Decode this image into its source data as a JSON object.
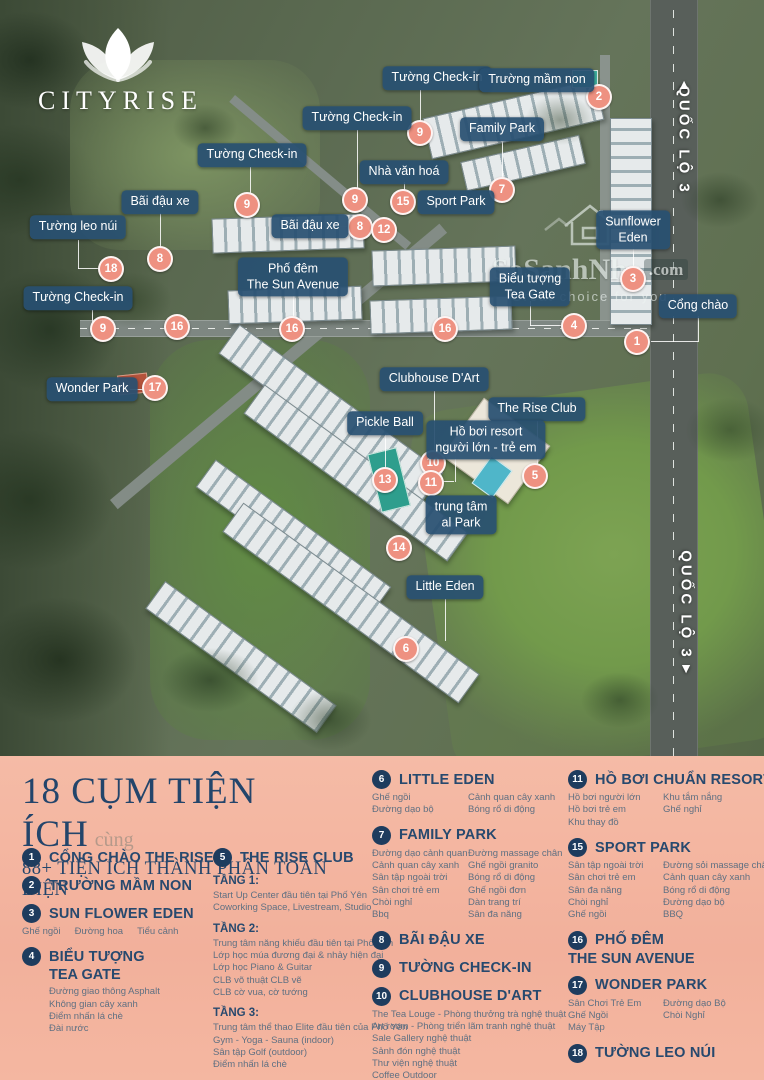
{
  "logo": {
    "brand": "CITYRISE"
  },
  "watermark": {
    "main": "SoSanhNha",
    "suffix": ".com",
    "tagline": "Great choice for you"
  },
  "map": {
    "callouts": [
      {
        "lines": [
          "Tường Check-in"
        ],
        "x": 437,
        "y": 78
      },
      {
        "lines": [
          "Trường mầm non"
        ],
        "x": 537,
        "y": 80
      },
      {
        "lines": [
          "Tường Check-in"
        ],
        "x": 357,
        "y": 118
      },
      {
        "lines": [
          "Family Park"
        ],
        "x": 502,
        "y": 129
      },
      {
        "lines": [
          "Tường Check-in"
        ],
        "x": 252,
        "y": 155
      },
      {
        "lines": [
          "Nhà văn hoá"
        ],
        "x": 404,
        "y": 172
      },
      {
        "lines": [
          "Sport Park"
        ],
        "x": 456,
        "y": 202
      },
      {
        "lines": [
          "Bãi đậu xe"
        ],
        "x": 160,
        "y": 202
      },
      {
        "lines": [
          "Bãi đậu xe"
        ],
        "x": 310,
        "y": 226
      },
      {
        "lines": [
          "Tường leo núi"
        ],
        "x": 78,
        "y": 227
      },
      {
        "lines": [
          "Phố đêm",
          "The Sun Avenue"
        ],
        "x": 293,
        "y": 277
      },
      {
        "lines": [
          "Sunflower",
          "Eden"
        ],
        "x": 633,
        "y": 230
      },
      {
        "lines": [
          "Biểu tượng",
          "Tea Gate"
        ],
        "x": 530,
        "y": 287
      },
      {
        "lines": [
          "Tường Check-in"
        ],
        "x": 78,
        "y": 298
      },
      {
        "lines": [
          "Cổng chào"
        ],
        "x": 698,
        "y": 306
      },
      {
        "lines": [
          "Wonder Park"
        ],
        "x": 92,
        "y": 389
      },
      {
        "lines": [
          "Clubhouse D'Art"
        ],
        "x": 434,
        "y": 379
      },
      {
        "lines": [
          "The Rise Club"
        ],
        "x": 537,
        "y": 409
      },
      {
        "lines": [
          "Pickle Ball"
        ],
        "x": 385,
        "y": 423
      },
      {
        "lines": [
          "Hồ bơi resort",
          "người lớn - trẻ em"
        ],
        "x": 486,
        "y": 440
      },
      {
        "lines": [
          "trung tâm",
          "al Park"
        ],
        "x": 461,
        "y": 515
      },
      {
        "lines": [
          "Little Eden"
        ],
        "x": 445,
        "y": 587
      }
    ],
    "badges": [
      {
        "n": "1",
        "x": 637,
        "y": 342
      },
      {
        "n": "2",
        "x": 599,
        "y": 97
      },
      {
        "n": "3",
        "x": 633,
        "y": 279
      },
      {
        "n": "4",
        "x": 574,
        "y": 326
      },
      {
        "n": "5",
        "x": 535,
        "y": 476
      },
      {
        "n": "6",
        "x": 406,
        "y": 649
      },
      {
        "n": "7",
        "x": 502,
        "y": 190
      },
      {
        "n": "8",
        "x": 160,
        "y": 259
      },
      {
        "n": "8",
        "x": 360,
        "y": 227
      },
      {
        "n": "9",
        "x": 420,
        "y": 133
      },
      {
        "n": "9",
        "x": 355,
        "y": 200
      },
      {
        "n": "9",
        "x": 247,
        "y": 205
      },
      {
        "n": "9",
        "x": 103,
        "y": 329
      },
      {
        "n": "10",
        "x": 433,
        "y": 463
      },
      {
        "n": "11",
        "x": 431,
        "y": 483
      },
      {
        "n": "12",
        "x": 384,
        "y": 230
      },
      {
        "n": "13",
        "x": 385,
        "y": 480
      },
      {
        "n": "14",
        "x": 399,
        "y": 548
      },
      {
        "n": "15",
        "x": 403,
        "y": 202
      },
      {
        "n": "16",
        "x": 177,
        "y": 327
      },
      {
        "n": "16",
        "x": 292,
        "y": 329
      },
      {
        "n": "16",
        "x": 445,
        "y": 329
      },
      {
        "n": "17",
        "x": 155,
        "y": 388
      },
      {
        "n": "18",
        "x": 111,
        "y": 269
      }
    ],
    "lines": [
      {
        "x": 420,
        "y": 90,
        "h": 38
      },
      {
        "x": 357,
        "y": 130,
        "h": 62
      },
      {
        "x": 250,
        "y": 167,
        "h": 32
      },
      {
        "x": 160,
        "y": 213,
        "h": 38
      },
      {
        "x": 78,
        "y": 240,
        "h": 29
      },
      {
        "x": 78,
        "y": 268,
        "w": 26
      },
      {
        "x": 337,
        "y": 226,
        "w": 15
      },
      {
        "x": 404,
        "y": 182,
        "h": 13
      },
      {
        "x": 502,
        "y": 141,
        "h": 41
      },
      {
        "x": 633,
        "y": 244,
        "h": 27
      },
      {
        "x": 530,
        "y": 301,
        "h": 25
      },
      {
        "x": 530,
        "y": 325,
        "w": 37
      },
      {
        "x": 698,
        "y": 316,
        "h": 26
      },
      {
        "x": 651,
        "y": 341,
        "w": 47
      },
      {
        "x": 130,
        "y": 389,
        "w": 18
      },
      {
        "x": 434,
        "y": 391,
        "h": 64
      },
      {
        "x": 537,
        "y": 421,
        "h": 47
      },
      {
        "x": 385,
        "y": 434,
        "h": 38
      },
      {
        "x": 455,
        "y": 456,
        "h": 26
      },
      {
        "x": 438,
        "y": 481,
        "w": 16
      },
      {
        "x": 445,
        "y": 599,
        "h": 42
      },
      {
        "x": 92,
        "y": 310,
        "h": 18
      },
      {
        "x": 293,
        "y": 293,
        "h": 28
      }
    ],
    "road_labels": [
      {
        "text": "QUỐC LỘ 3",
        "x": 684,
        "y": 140,
        "arrow": "▲",
        "arrow_x": 684,
        "arrow_y": 84
      },
      {
        "text": "QUỐC LỘ 3",
        "x": 686,
        "y": 605,
        "arrow": "▼",
        "arrow_x": 686,
        "arrow_y": 668
      }
    ]
  },
  "legend": {
    "title_main": "18 CỤM TIỆN ÍCH",
    "title_suffix": "cùng",
    "subtitle": "88+ TIỆN ÍCH THÀNH PHẦN TOÀN DIỆN",
    "columns": [
      {
        "x": 22,
        "y": 92,
        "w": 185,
        "items": [
          {
            "num": "1",
            "title_lines": [
              "CỔNG CHÀO THE RISE"
            ]
          },
          {
            "num": "2",
            "title_lines": [
              "TRƯỜNG MẦM NON"
            ]
          },
          {
            "num": "3",
            "title_lines": [
              "SUN FLOWER EDEN"
            ],
            "sub_inline": [
              "Ghế ngồi",
              "Đường hoa",
              "Tiểu cảnh"
            ]
          },
          {
            "num": "4",
            "title_lines": [
              "BIỂU TƯỢNG",
              "TEA GATE"
            ],
            "subs_indent": true,
            "sub_lines": [
              "Đường giao thông Asphalt",
              "Không gian cây xanh",
              "Điểm nhấn lá chè",
              "Đài nước"
            ]
          }
        ]
      },
      {
        "x": 213,
        "y": 92,
        "w": 165,
        "items": [
          {
            "num": "5",
            "title_lines": [
              "THE RISE CLUB"
            ],
            "sections": [
              {
                "heading": "TẦNG 1:",
                "lines": [
                  "Start Up Center đầu tiên tại Phố Yên",
                  "Coworking Space, Livestream, Studio"
                ]
              },
              {
                "heading": "TẦNG 2:",
                "lines": [
                  "Trung tâm năng khiếu đầu tiên tại Phố Yên",
                  "Lớp học múa đương đại & nhảy hiện đại",
                  "Lớp học Piano & Guitar",
                  "CLB võ thuật CLB vẽ",
                  "CLB cờ vua, cờ tướng"
                ]
              },
              {
                "heading": "TẦNG 3:",
                "lines": [
                  "Trung tâm thể thao Elite đầu tiên của Phố Yên",
                  "Gym - Yoga - Sauna (indoor)",
                  "Sân tập Golf (outdoor)",
                  "Điểm nhấn lá chè"
                ]
              }
            ]
          }
        ]
      },
      {
        "x": 372,
        "y": 14,
        "w": 192,
        "items": [
          {
            "num": "6",
            "title_lines": [
              "LITTLE EDEN"
            ],
            "sub_cols": [
              [
                "Ghế ngồi",
                "Đường dạo bộ"
              ],
              [
                "Cảnh quan cây xanh",
                "Bóng rổ di động"
              ]
            ]
          },
          {
            "num": "7",
            "title_lines": [
              "FAMILY PARK"
            ],
            "sub_cols": [
              [
                "Đường dạo cảnh quan",
                "Cảnh quan cây xanh",
                "Sân tập ngoài trời",
                "Sân chơi trẻ em",
                "Chòi nghỉ",
                "Bbq"
              ],
              [
                "Đường massage chân",
                "Ghế ngồi granito",
                "Bóng rổ di động",
                "Ghế ngồi đơn",
                "Dàn trang trí",
                "Sân đa năng"
              ]
            ]
          },
          {
            "num": "8",
            "title_lines": [
              "BÃI ĐẬU XE"
            ]
          },
          {
            "num": "9",
            "title_lines": [
              "TƯỜNG CHECK-IN"
            ]
          },
          {
            "num": "10",
            "title_lines": [
              "CLUBHOUSE D'ART"
            ],
            "sub_lines": [
              "The Tea Louge - Phòng thưởng trà nghệ thuật",
              "Art room - Phòng triển lãm tranh nghệ thuật",
              "Sale Gallery nghệ thuật",
              "Sảnh đón nghệ thuật",
              "Thư viện nghệ thuật",
              "Coffee Outdoor",
              "Smoking Zone",
              "Coffee Louge"
            ]
          }
        ]
      },
      {
        "x": 568,
        "y": 14,
        "w": 190,
        "items": [
          {
            "num": "11",
            "title_lines": [
              "HỒ BƠI CHUẨN RESORT"
            ],
            "sub_cols": [
              [
                "Hồ bơi người lớn",
                "Hồ bơi trẻ em",
                "Khu thay đồ"
              ],
              [
                "Khu tắm nắng",
                "Ghế nghỉ"
              ]
            ]
          },
          {
            "num": "15",
            "title_lines": [
              "SPORT PARK"
            ],
            "sub_cols": [
              [
                "Sân tập ngoài trời",
                "Sân chơi trẻ em",
                "Sân đa năng",
                "Chòi nghỉ",
                "Ghế ngồi"
              ],
              [
                "Đường sỏi massage chân",
                "Cảnh quan cây xanh",
                "Bóng rổ di động",
                "Đường dạo bộ",
                "BBQ"
              ]
            ]
          },
          {
            "num": "16",
            "title_lines": [
              "PHỐ ĐÊM",
              "THE SUN AVENUE"
            ],
            "title2_flush": true
          },
          {
            "num": "17",
            "title_lines": [
              "WONDER PARK"
            ],
            "sub_cols": [
              [
                "Sân Chơi Trẻ Em",
                "Ghế Ngồi",
                "Máy Tập"
              ],
              [
                "Đường dạo Bộ",
                "Chòi Nghỉ"
              ]
            ]
          },
          {
            "num": "18",
            "title_lines": [
              "TƯỜNG LEO NÚI"
            ]
          }
        ]
      }
    ]
  },
  "colors": {
    "panel_bg": "#f3b29d",
    "navy": "#27496e",
    "badge_coral": "#ee9181",
    "pill_blue": "#285071",
    "sub_text": "#5f7082"
  }
}
